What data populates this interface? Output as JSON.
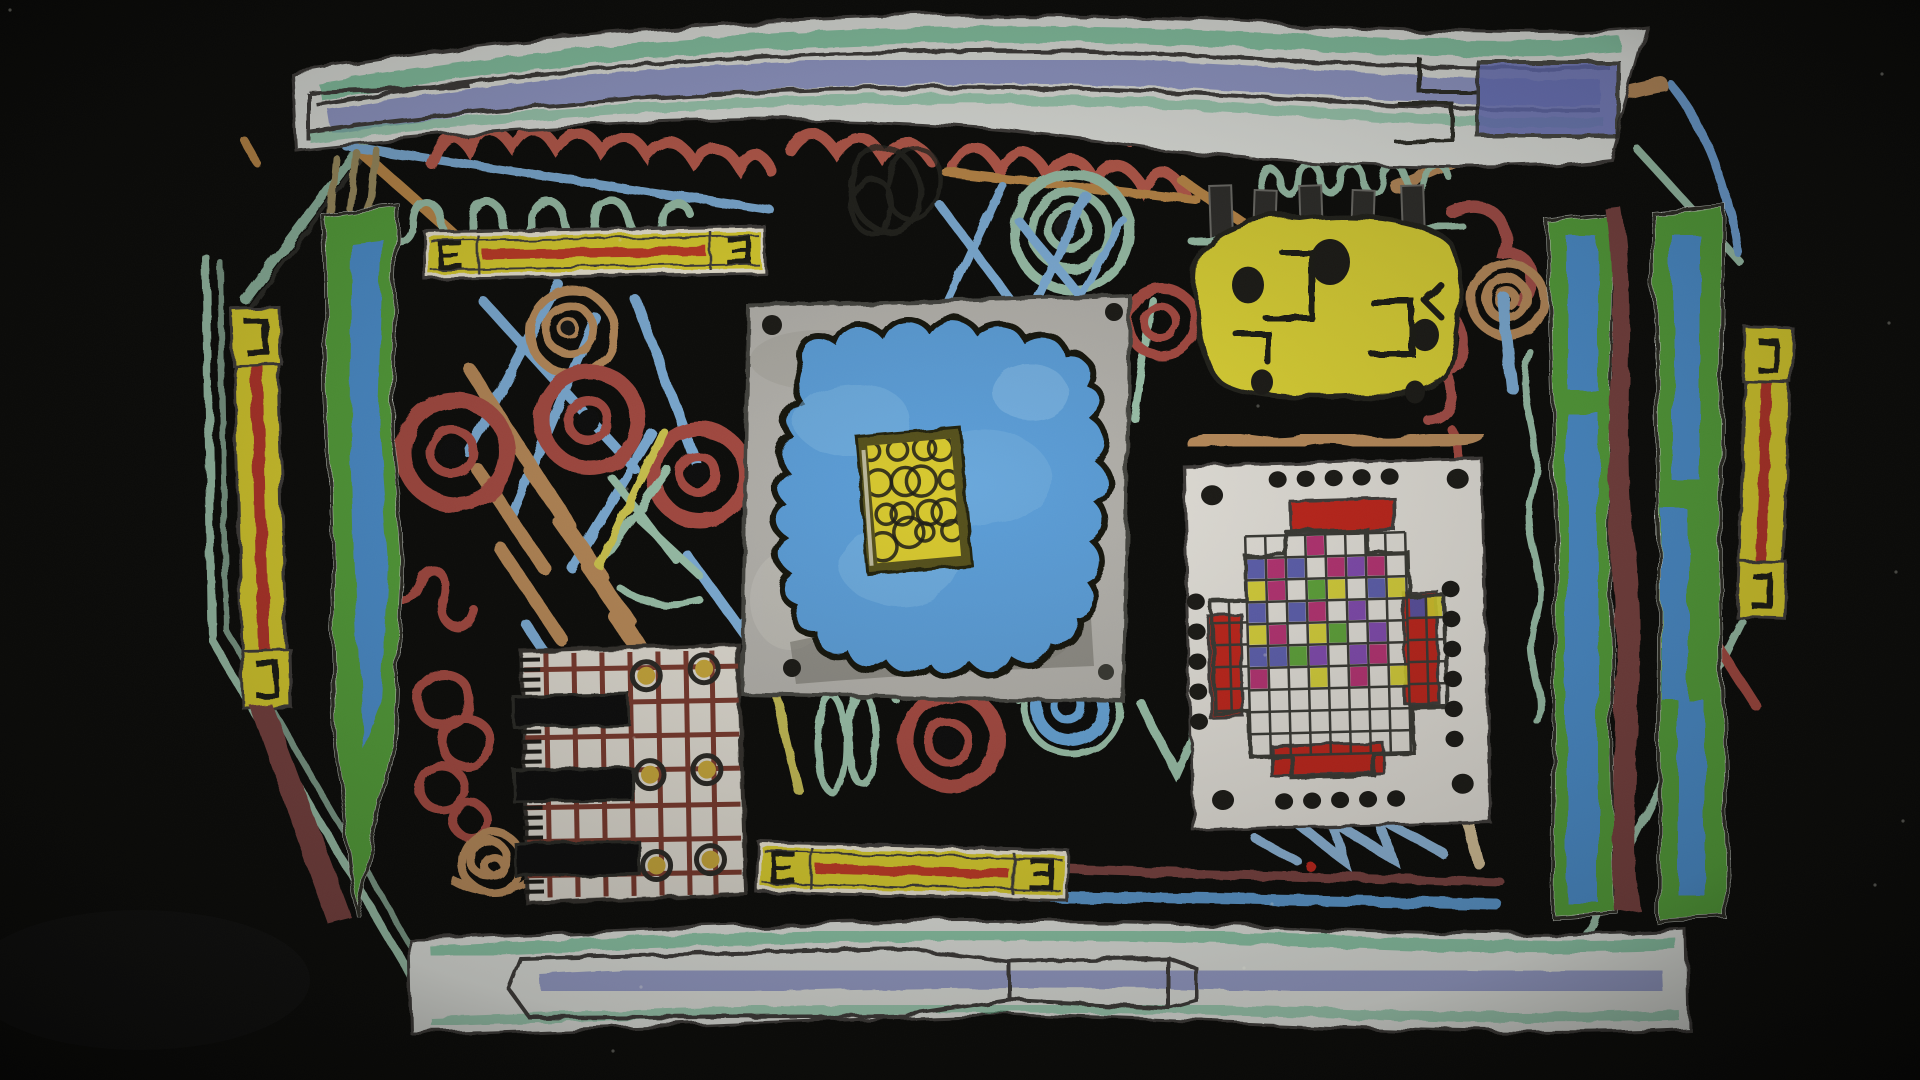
{
  "artwork": {
    "kind": "photograph-of-crayon-collage-on-black-board",
    "background": "#0c0c0a"
  },
  "palette": {
    "black_board": "#0c0c0a",
    "pencil": "#3f3e3a",
    "ink_black": "#1c1b17",
    "paper_white": "#e6e8e3",
    "card_white": "#e4e1da",
    "comb_white": "#e0dcd2",
    "green_crayon": "#74c39a",
    "lavender": "#8a92cb",
    "indigo_patch": "#5d67bd",
    "light_blue": "#7fb0da",
    "sage": "#9cc3ab",
    "salmon_red": "#bd5b4e",
    "brick": "#a84b43",
    "maroon": "#7a4340",
    "bar_green": "#56a33a",
    "bar_green_dark": "#3f8c2b",
    "bar_blue": "#4e92d2",
    "strip_yellow": "#ddd02f",
    "deep_yellow": "#d2b733",
    "tan": "#bb8d5c",
    "olive_border": "#56511d",
    "panel_gray": "#b4b2ac",
    "blob_blue": "#5c9ed8",
    "blob_blue_light": "#7ab5e2",
    "chip_yellow": "#d8c92f",
    "mosaic_red": "#c1271c",
    "comb_grid": "#7a3a2e",
    "dot_yellow": "#c9a83b"
  },
  "panels": {
    "mosaic": {
      "cols": 8,
      "rows": 8,
      "matrix": [
        "...M....",
        "BMB.MPM.",
        "YM.GY.BY",
        "B.BM.P..",
        "YM.YG.P.",
        "BBGP.PM.",
        "M..Y.M.Y",
        "........"
      ],
      "colors": {
        "M": "#b3256b",
        "B": "#5456ad",
        "Y": "#d6cf2e",
        "G": "#55a02e",
        "P": "#7b3fae"
      },
      "wing_cells_right": [
        "B",
        "Y"
      ]
    },
    "mandala_dots": {
      "top": 5,
      "bottom": 5,
      "left": 5,
      "right": 6,
      "corners": 4
    },
    "comb": {
      "verticals": [
        548,
        576,
        604,
        632,
        660,
        688,
        714
      ],
      "horizontals": [
        668,
        702,
        736,
        770,
        806,
        840,
        874
      ],
      "dots": [
        [
          648,
          676
        ],
        [
          706,
          670
        ],
        [
          650,
          775
        ],
        [
          707,
          771
        ],
        [
          655,
          866
        ],
        [
          709,
          861
        ]
      ],
      "teeth_tick_rows": [
        [
          658,
          668,
          678,
          688
        ],
        [
          730,
          740,
          750,
          760
        ],
        [
          806,
          816,
          826,
          836
        ],
        [
          880,
          890
        ]
      ]
    },
    "chip": {
      "ring_count": 16
    },
    "yellow_blob": {
      "pin_count": 5,
      "dot_count": 5
    },
    "level_bars": 2
  }
}
